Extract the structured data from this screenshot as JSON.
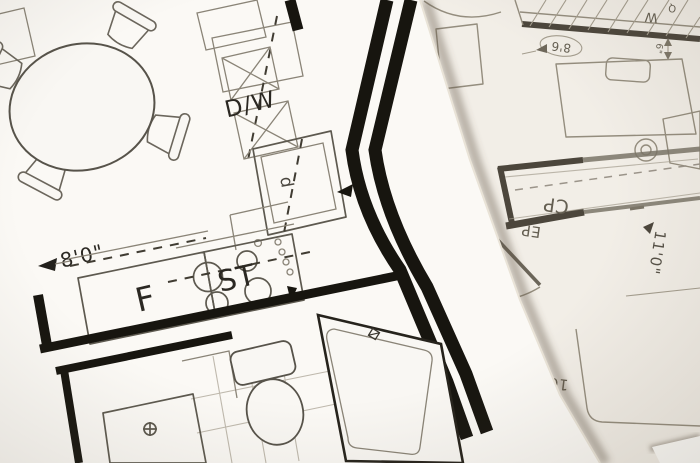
{
  "photo": {
    "description": "Photograph of two overlapping architectural floor plan sheets",
    "colors": {
      "paper_top": "#fbf9f5",
      "paper_under": "#f2eee7",
      "paper_corner": "#fdfcf9",
      "ink_wall": "#17150f",
      "ink_thin": "#5d594f",
      "ink_under": "#8d8679",
      "text_top": "#2b2822",
      "text_under": "#655f52"
    }
  },
  "sheet_top": {
    "labels": {
      "dishwasher": "D/W",
      "refrigerator": "F",
      "stove": "ST",
      "dim_width": "8'0\"",
      "sink": "d"
    }
  },
  "sheet_under": {
    "labels": {
      "carpet": "CP",
      "panel": "EP",
      "closet": "W",
      "closet_small": "Q",
      "dim_bubble": "8'6",
      "dim_door": "6'0",
      "dim_small": "6\"",
      "dim_side": "11'0\"",
      "dim_bottom": "10'0",
      "sink": "d"
    }
  }
}
